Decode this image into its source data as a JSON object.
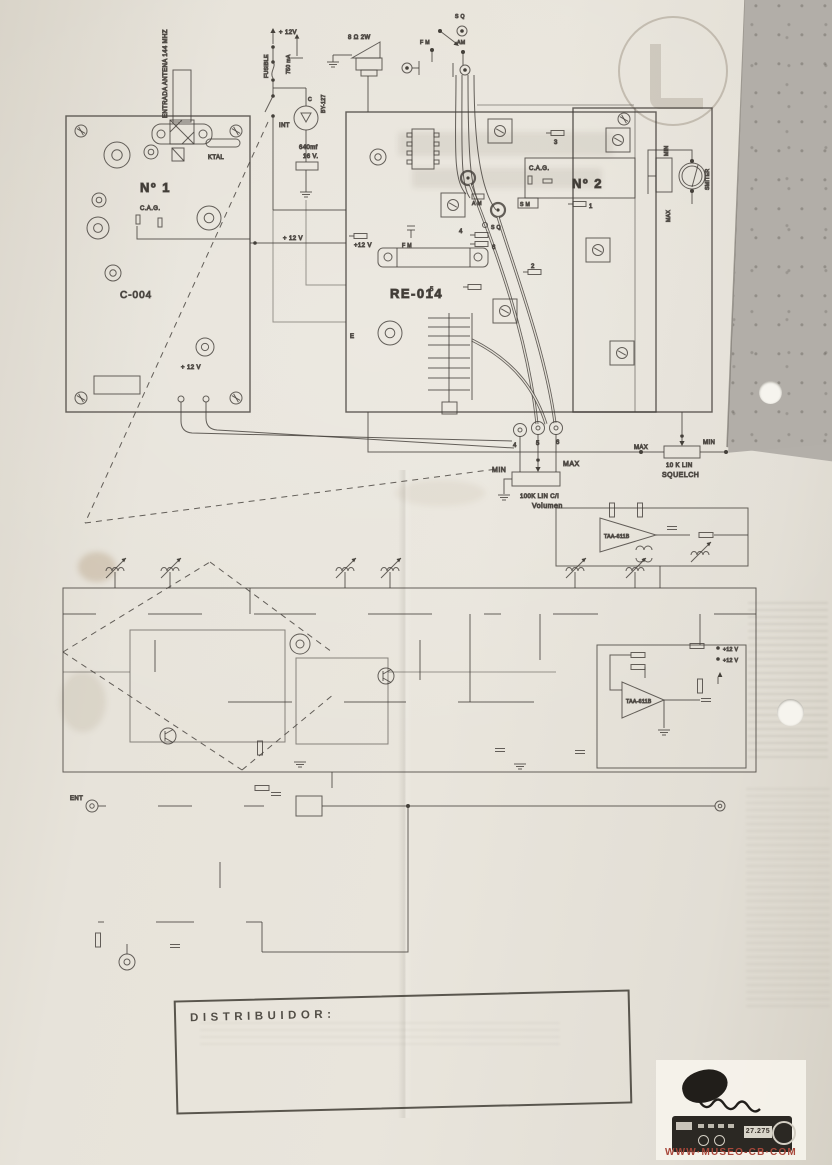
{
  "doc": {
    "distribuidor": "DISTRIBUIDOR:"
  },
  "wiring": {
    "antenna": "ENTRADA ANTENA 144 MHZ",
    "power": {
      "v12_top": "+ 12V",
      "fusible": "FUSIBLE",
      "rating": "750 mA",
      "int": "INT",
      "c": "C",
      "diode": "BY-127",
      "cap": "640mf",
      "cap_v": "16 V."
    },
    "speaker": "8 Ω  2W",
    "jacks": {
      "sq": "S Q",
      "fm": "F M",
      "am": "AM"
    },
    "board1": {
      "name": "Nº 1",
      "code": "C-004",
      "cag": "C.A.G.",
      "ktal": "KTAL",
      "v12": "+ 12 V"
    },
    "link_v12": "+ 12 V",
    "re": {
      "name": "RE-014",
      "v12": "+12 V",
      "fm": "F M",
      "am": "A M",
      "sq": "S Q",
      "e": "E",
      "p2": "2",
      "p3": "3",
      "p4": "4",
      "p5": "5",
      "p6": "6"
    },
    "board2": {
      "name": "Nº 2",
      "cag": "C.A.G.",
      "sm": "S M",
      "p1": "1",
      "meter": "SMITER",
      "min": "MIN",
      "max": "MAX"
    },
    "volume": {
      "p4": "4",
      "p5": "5",
      "p6": "6",
      "min": "MIN",
      "max": "MAX",
      "value": "100K LIN  C/I",
      "name": "Volumen"
    },
    "squelch": {
      "max": "MAX",
      "min": "MIN",
      "value": "10 K LIN",
      "name": "SQUELCH"
    }
  },
  "schematic": {
    "ent": "ENT",
    "amp1": "TAA-611B",
    "amp2": "TAA-611B",
    "v12_a": "+12 V",
    "v12_b": "+12 V"
  },
  "watermark": {
    "site": "WWW·MUSEO-CB·COM",
    "freq": "27.275"
  },
  "colors": {
    "ink": "#3f3b34",
    "paper": "#e4e0d7",
    "accent_red": "#a8473a"
  }
}
